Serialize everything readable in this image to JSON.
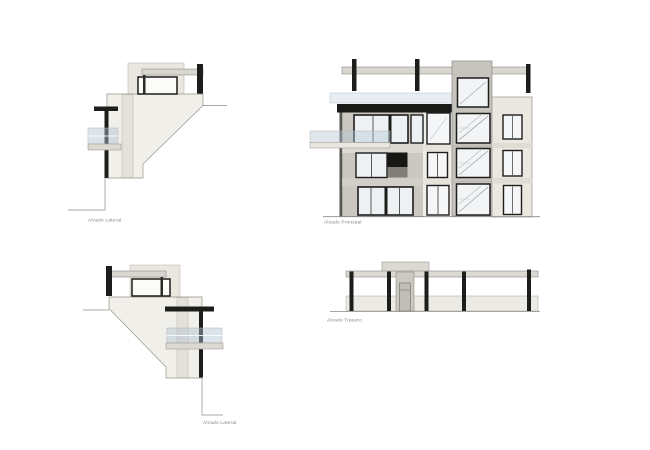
{
  "sheet": {
    "background": "#ffffff",
    "labels": {
      "lateral_top": "Alzado Lateral",
      "principal": "Alzado Principal",
      "lateral_bottom": "Alzado Lateral",
      "trasero": "Alzado Trasero"
    },
    "colors": {
      "ink_black": "#1d1d1b",
      "outline_gray": "#8e8b85",
      "cream_wall": "#f1efe9",
      "beam_gray": "#d9d6d0",
      "facade_gray": "#cbc8c2",
      "tower_gray": "#c7c4be",
      "right_wall_cream": "#ebe8e1",
      "glass_white": "#eef1f3",
      "glass_rail_tint": "rgba(178,196,210,0.45)",
      "recess_dark": "#171715",
      "label_text": "#85827c"
    }
  }
}
